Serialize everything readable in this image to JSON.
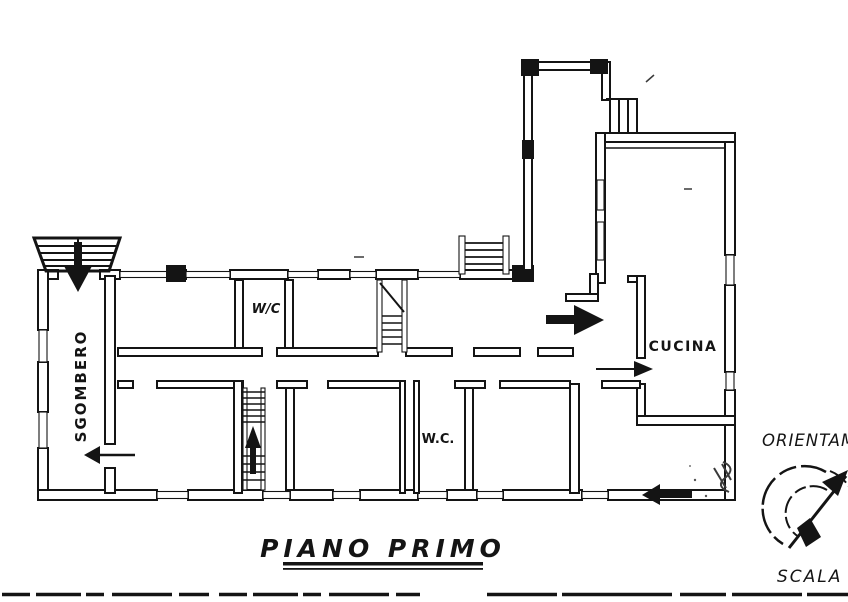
{
  "floor_plan": {
    "title": "PIANO PRIMO",
    "room_labels": {
      "storage": "SGOMBERO",
      "wc_upper": "W/C",
      "wc_lower": "W.C.",
      "kitchen": "CUCINA"
    }
  },
  "side_annotations": {
    "orientation_label": "ORIENTAM",
    "scale_label": "SCALA D"
  },
  "icons": {
    "compass": "compass-north-arrow-icon",
    "door_arrows": "entry-direction-arrow-icon"
  },
  "colors": {
    "ink": "#141414",
    "paper": "#ffffff"
  }
}
